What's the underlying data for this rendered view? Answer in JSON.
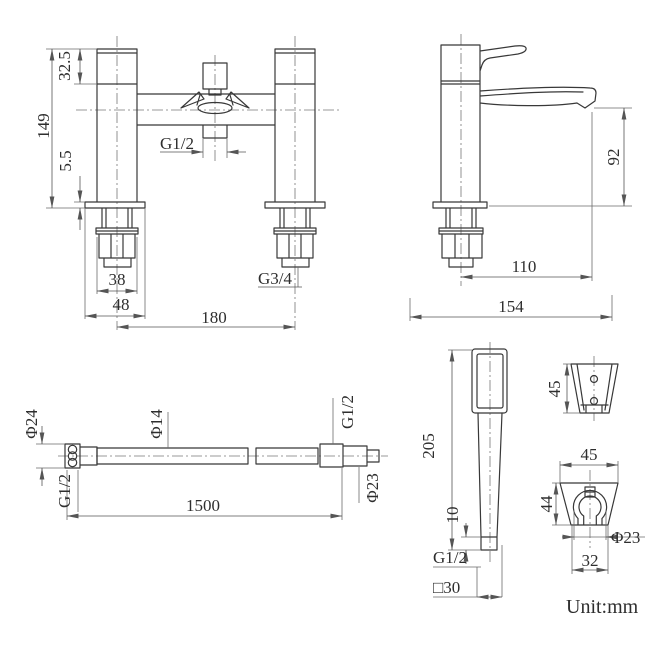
{
  "meta": {
    "background_color": "#ffffff",
    "line_color": "#383838",
    "dim_line_color": "#6b6b6b",
    "unit_label": "Unit:mm"
  },
  "views": {
    "mixer_front": {
      "name": "bath-shower-mixer-front-view",
      "dims": {
        "height_upper": "32.5",
        "height_total": "149",
        "base_plate": "5.5",
        "outlet_thread": "G1/2",
        "nut_width": "38",
        "flange_width": "48",
        "inlet_thread": "G3/4",
        "centers": "180"
      }
    },
    "mixer_side": {
      "name": "bath-shower-mixer-side-view",
      "dims": {
        "spout_height": "92",
        "spout_reach": "110",
        "depth": "154"
      }
    },
    "hose": {
      "name": "shower-hose-view",
      "dims": {
        "nut_od": "Φ24",
        "nut_thread": "G1/2",
        "hose_od": "Φ14",
        "conn_thread": "G1/2",
        "conn_od": "Φ23",
        "length": "1500"
      }
    },
    "handset": {
      "name": "shower-handset-view",
      "dims": {
        "length": "205",
        "tip_length": "10",
        "thread": "G1/2",
        "head_square": "□30"
      }
    },
    "bracket_side": {
      "name": "wall-bracket-side-view",
      "dims": {
        "height": "45"
      }
    },
    "bracket_front": {
      "name": "wall-bracket-front-view",
      "dims": {
        "width_top": "45",
        "height": "44",
        "hole": "Φ23",
        "width_bottom": "32"
      }
    }
  }
}
